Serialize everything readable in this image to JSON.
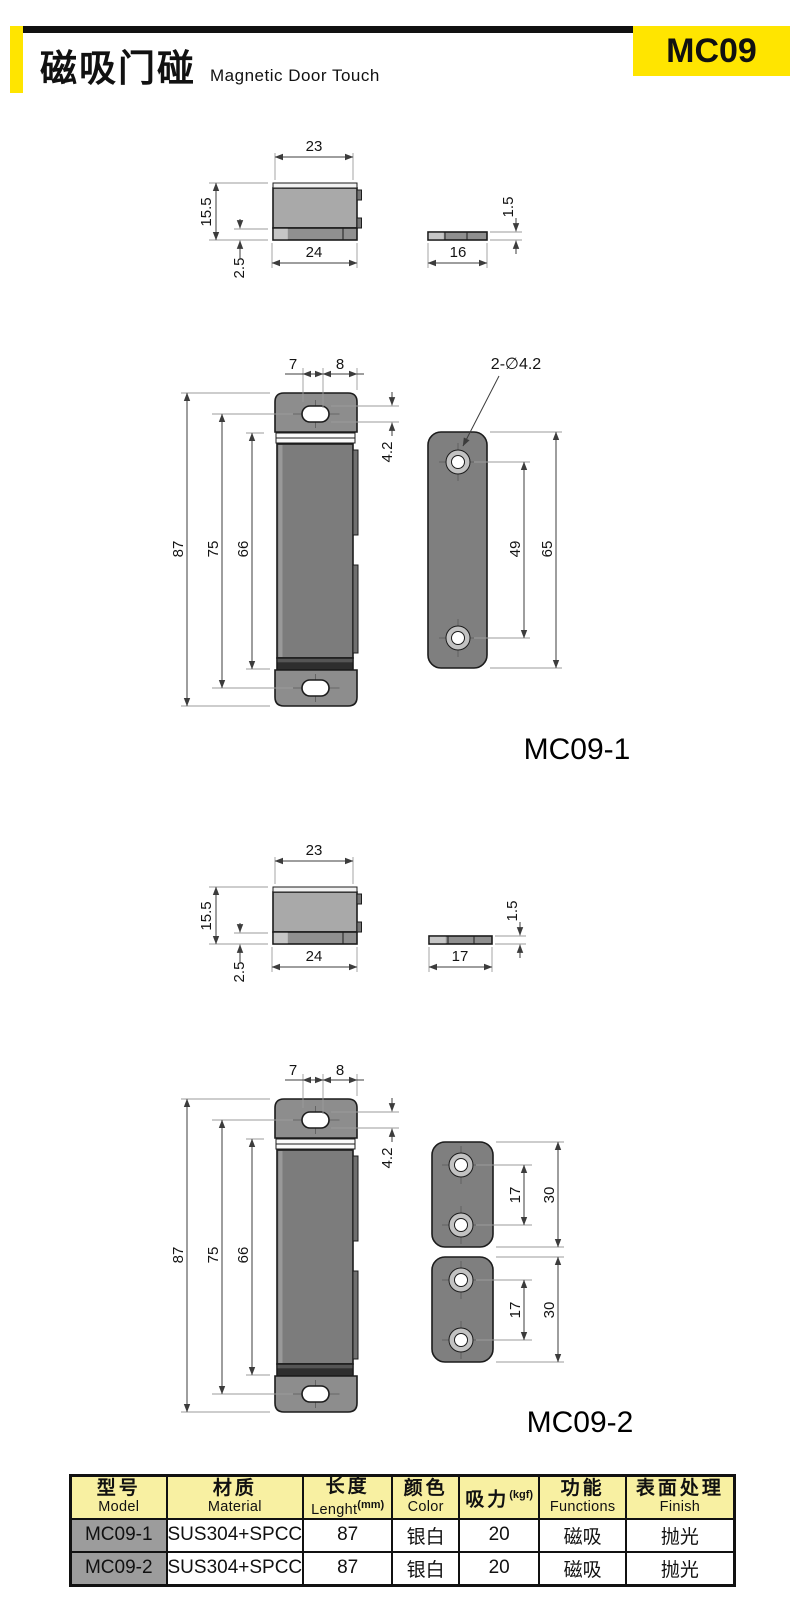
{
  "header": {
    "title_cn": "磁吸门碰",
    "title_en": "Magnetic Door Touch",
    "badge": "MC09"
  },
  "colors": {
    "accent_yellow": "#FFE500",
    "table_header_bg": "#F8F0A2",
    "model_cell_bg": "#9C9C9C",
    "body_gray": "#7C7C7C"
  },
  "labels": {
    "variant1": "MC09-1",
    "variant2": "MC09-2"
  },
  "dims": {
    "s1": {
      "top_width": "23",
      "height": "15.5",
      "bottom_width": "24",
      "base_height": "2.5",
      "plate_thickness": "1.5",
      "plate_width": "16"
    },
    "f1": {
      "offset7": "7",
      "offset8": "8",
      "note": "2-∅4.2",
      "slot": "4.2",
      "total": "87",
      "body": "75",
      "magnet": "66",
      "hole_span": "49",
      "plate_height": "65"
    },
    "s2": {
      "top_width": "23",
      "height": "15.5",
      "bottom_width": "24",
      "base_height": "2.5",
      "plate_thickness": "1.5",
      "plate_width": "17"
    },
    "f2": {
      "offset7": "7",
      "offset8": "8",
      "slot": "4.2",
      "total": "87",
      "body": "75",
      "magnet": "66",
      "p1_span": "17",
      "p1_height": "30",
      "p2_span": "17",
      "p2_height": "30"
    }
  },
  "table": {
    "headers": [
      {
        "cn": "型号",
        "en": "Model"
      },
      {
        "cn": "材质",
        "en": "Material"
      },
      {
        "cn": "长度",
        "en": "Lenght",
        "en_sup": "(mm)"
      },
      {
        "cn": "颜色",
        "en": "Color"
      },
      {
        "cn": "吸力",
        "cn_sup": "(kgf)"
      },
      {
        "cn": "功能",
        "en": "Functions"
      },
      {
        "cn": "表面处理",
        "en": "Finish"
      }
    ],
    "rows": [
      [
        "MC09-1",
        "SUS304+SPCC",
        "87",
        "银白",
        "20",
        "磁吸",
        "抛光"
      ],
      [
        "MC09-2",
        "SUS304+SPCC",
        "87",
        "银白",
        "20",
        "磁吸",
        "抛光"
      ]
    ]
  }
}
